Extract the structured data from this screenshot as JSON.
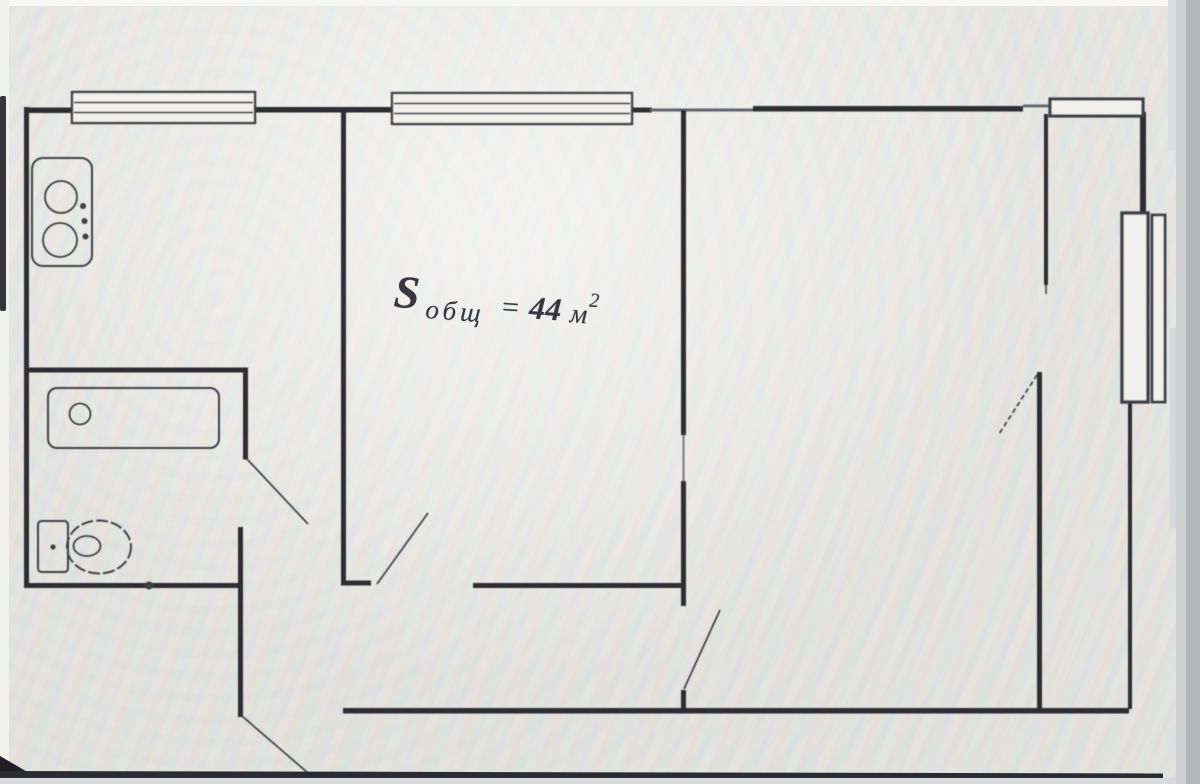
{
  "area_label": {
    "full_text": "S общ = 44 м2",
    "prefix": "S",
    "subscript": "общ",
    "equals": "=",
    "value": "44",
    "unit": "м",
    "exponent": "2"
  },
  "colors": {
    "wall_dark": "#2d2e32",
    "line": "#3e3f45",
    "photo_background": "#eae9e5",
    "window_fill": "#f1f0ed",
    "edge_gray": "#b3b6b9",
    "edge_dark": "#2a2a2e",
    "label_ink": "#37373d"
  },
  "icons": [
    {
      "name": "stove-icon"
    },
    {
      "name": "bathtub-icon"
    },
    {
      "name": "toilet-icon"
    },
    {
      "name": "window-icon"
    },
    {
      "name": "door-swing-icon"
    }
  ]
}
